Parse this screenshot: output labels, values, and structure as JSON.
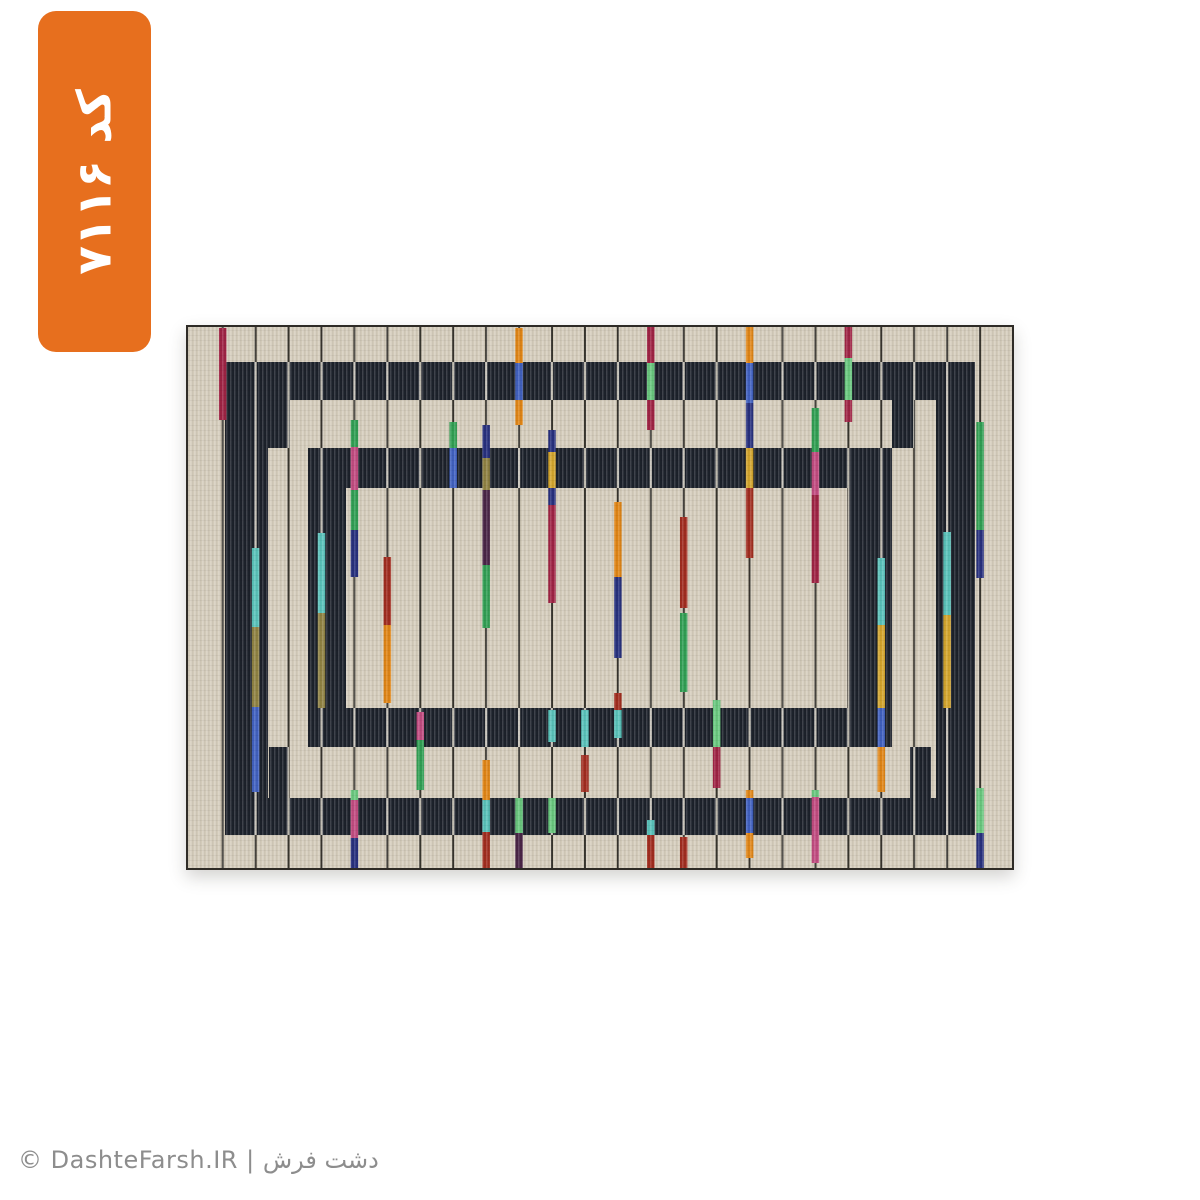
{
  "page": {
    "background": "#ffffff"
  },
  "badge": {
    "code_label": "کد ۷۱۱۶",
    "bg_color": "#e76f1e",
    "text_color": "#ffffff"
  },
  "watermark": {
    "text": "© DashteFarsh.IR | دشت فرش",
    "color": "#8d8d8d"
  },
  "carpet": {
    "width": 828,
    "height": 545,
    "palette": {
      "beige": "#d5cdbc",
      "navy_band": "#1a1f29",
      "line_dark": "#35322c",
      "line_light": "#d8d3c7",
      "border": "#2e2b26",
      "crimson": "#9e2143",
      "darkred": "#a02a1d",
      "orange": "#e08414",
      "gold": "#d3a42c",
      "olive": "#8f8142",
      "royal": "#3f5fc0",
      "navy": "#252e7d",
      "green": "#2f9e52",
      "mint": "#68c77e",
      "teal": "#58c2ba",
      "magenta": "#c14a80",
      "darkpurple": "#472245"
    },
    "frames": [
      {
        "x": 39,
        "y": 37,
        "w": 750,
        "h": 38
      },
      {
        "x": 39,
        "y": 473,
        "w": 750,
        "h": 37
      },
      {
        "x": 39,
        "y": 37,
        "w": 43,
        "h": 473
      },
      {
        "x": 750,
        "y": 37,
        "w": 39,
        "h": 473
      },
      {
        "x": 122,
        "y": 123,
        "w": 584,
        "h": 40
      },
      {
        "x": 122,
        "y": 383,
        "w": 584,
        "h": 39
      },
      {
        "x": 122,
        "y": 123,
        "w": 38,
        "h": 299
      },
      {
        "x": 662,
        "y": 123,
        "w": 44,
        "h": 299
      },
      {
        "x": 82,
        "y": 75,
        "w": 22,
        "h": 48
      },
      {
        "x": 706,
        "y": 75,
        "w": 22,
        "h": 48
      },
      {
        "x": 83,
        "y": 422,
        "w": 20,
        "h": 51
      },
      {
        "x": 724,
        "y": 422,
        "w": 21,
        "h": 51
      }
    ],
    "lines": {
      "count": 24,
      "x_start": 36.7,
      "spacing": 32.93,
      "width": 2
    },
    "stick_width": 7.5,
    "sticks": [
      {
        "col": 0,
        "segments": [
          [
            "crimson",
            3,
            95
          ]
        ]
      },
      {
        "col": 1,
        "segments": [
          [
            "teal",
            223,
            302
          ],
          [
            "olive",
            302,
            382
          ],
          [
            "royal",
            382,
            467
          ]
        ]
      },
      {
        "col": 3,
        "segments": [
          [
            "teal",
            208,
            288
          ],
          [
            "olive",
            288,
            383
          ]
        ]
      },
      {
        "col": 4,
        "segments": [
          [
            "green",
            95,
            122
          ],
          [
            "magenta",
            122,
            165
          ],
          [
            "green",
            165,
            205
          ],
          [
            "navy",
            205,
            252
          ],
          [
            "mint",
            465,
            475
          ],
          [
            "magenta",
            475,
            513
          ],
          [
            "navy",
            513,
            545
          ]
        ]
      },
      {
        "col": 5,
        "segments": [
          [
            "darkred",
            232,
            300
          ],
          [
            "orange",
            300,
            378
          ]
        ]
      },
      {
        "col": 6,
        "segments": [
          [
            "magenta",
            387,
            415
          ],
          [
            "green",
            415,
            465
          ]
        ]
      },
      {
        "col": 7,
        "segments": [
          [
            "green",
            97,
            123
          ],
          [
            "royal",
            123,
            163
          ]
        ]
      },
      {
        "col": 8,
        "segments": [
          [
            "navy",
            100,
            133
          ],
          [
            "olive",
            133,
            165
          ],
          [
            "darkpurple",
            165,
            240
          ],
          [
            "green",
            240,
            303
          ],
          [
            "orange",
            435,
            475
          ],
          [
            "teal",
            475,
            507
          ],
          [
            "darkred",
            507,
            545
          ]
        ]
      },
      {
        "col": 9,
        "segments": [
          [
            "orange",
            3,
            38
          ],
          [
            "royal",
            38,
            75
          ],
          [
            "orange",
            75,
            100
          ],
          [
            "mint",
            473,
            508
          ],
          [
            "darkpurple",
            508,
            545
          ]
        ]
      },
      {
        "col": 10,
        "segments": [
          [
            "navy",
            105,
            127
          ],
          [
            "gold",
            127,
            163
          ],
          [
            "navy",
            163,
            180
          ],
          [
            "crimson",
            180,
            278
          ],
          [
            "teal",
            385,
            417
          ],
          [
            "mint",
            473,
            508
          ]
        ]
      },
      {
        "col": 11,
        "segments": [
          [
            "teal",
            385,
            422
          ],
          [
            "darkred",
            430,
            467
          ]
        ]
      },
      {
        "col": 12,
        "segments": [
          [
            "orange",
            177,
            252
          ],
          [
            "navy",
            252,
            333
          ],
          [
            "darkred",
            368,
            385
          ],
          [
            "teal",
            385,
            413
          ]
        ]
      },
      {
        "col": 13,
        "segments": [
          [
            "crimson",
            2,
            38
          ],
          [
            "mint",
            38,
            75
          ],
          [
            "crimson",
            75,
            105
          ],
          [
            "teal",
            495,
            510
          ],
          [
            "darkred",
            510,
            545
          ]
        ]
      },
      {
        "col": 14,
        "segments": [
          [
            "darkred",
            192,
            283
          ],
          [
            "green",
            288,
            367
          ],
          [
            "darkred",
            512,
            545
          ]
        ]
      },
      {
        "col": 15,
        "segments": [
          [
            "mint",
            375,
            422
          ],
          [
            "crimson",
            422,
            463
          ]
        ]
      },
      {
        "col": 16,
        "segments": [
          [
            "orange",
            2,
            38
          ],
          [
            "royal",
            38,
            78
          ],
          [
            "navy",
            78,
            123
          ],
          [
            "gold",
            123,
            163
          ],
          [
            "darkred",
            163,
            233
          ],
          [
            "orange",
            465,
            473
          ],
          [
            "royal",
            473,
            508
          ],
          [
            "orange",
            508,
            533
          ]
        ]
      },
      {
        "col": 18,
        "segments": [
          [
            "green",
            83,
            127
          ],
          [
            "magenta",
            127,
            170
          ],
          [
            "crimson",
            170,
            258
          ],
          [
            "mint",
            465,
            472
          ],
          [
            "magenta",
            472,
            538
          ]
        ]
      },
      {
        "col": 19,
        "segments": [
          [
            "crimson",
            2,
            33
          ],
          [
            "mint",
            33,
            75
          ],
          [
            "crimson",
            75,
            97
          ]
        ]
      },
      {
        "col": 20,
        "segments": [
          [
            "teal",
            233,
            300
          ],
          [
            "gold",
            300,
            383
          ],
          [
            "royal",
            383,
            422
          ],
          [
            "orange",
            422,
            467
          ]
        ]
      },
      {
        "col": 22,
        "segments": [
          [
            "teal",
            207,
            290
          ],
          [
            "gold",
            290,
            383
          ]
        ]
      },
      {
        "col": 23,
        "segments": [
          [
            "green",
            97,
            205
          ],
          [
            "navy",
            205,
            253
          ],
          [
            "mint",
            463,
            508
          ],
          [
            "navy",
            508,
            545
          ]
        ]
      }
    ]
  }
}
